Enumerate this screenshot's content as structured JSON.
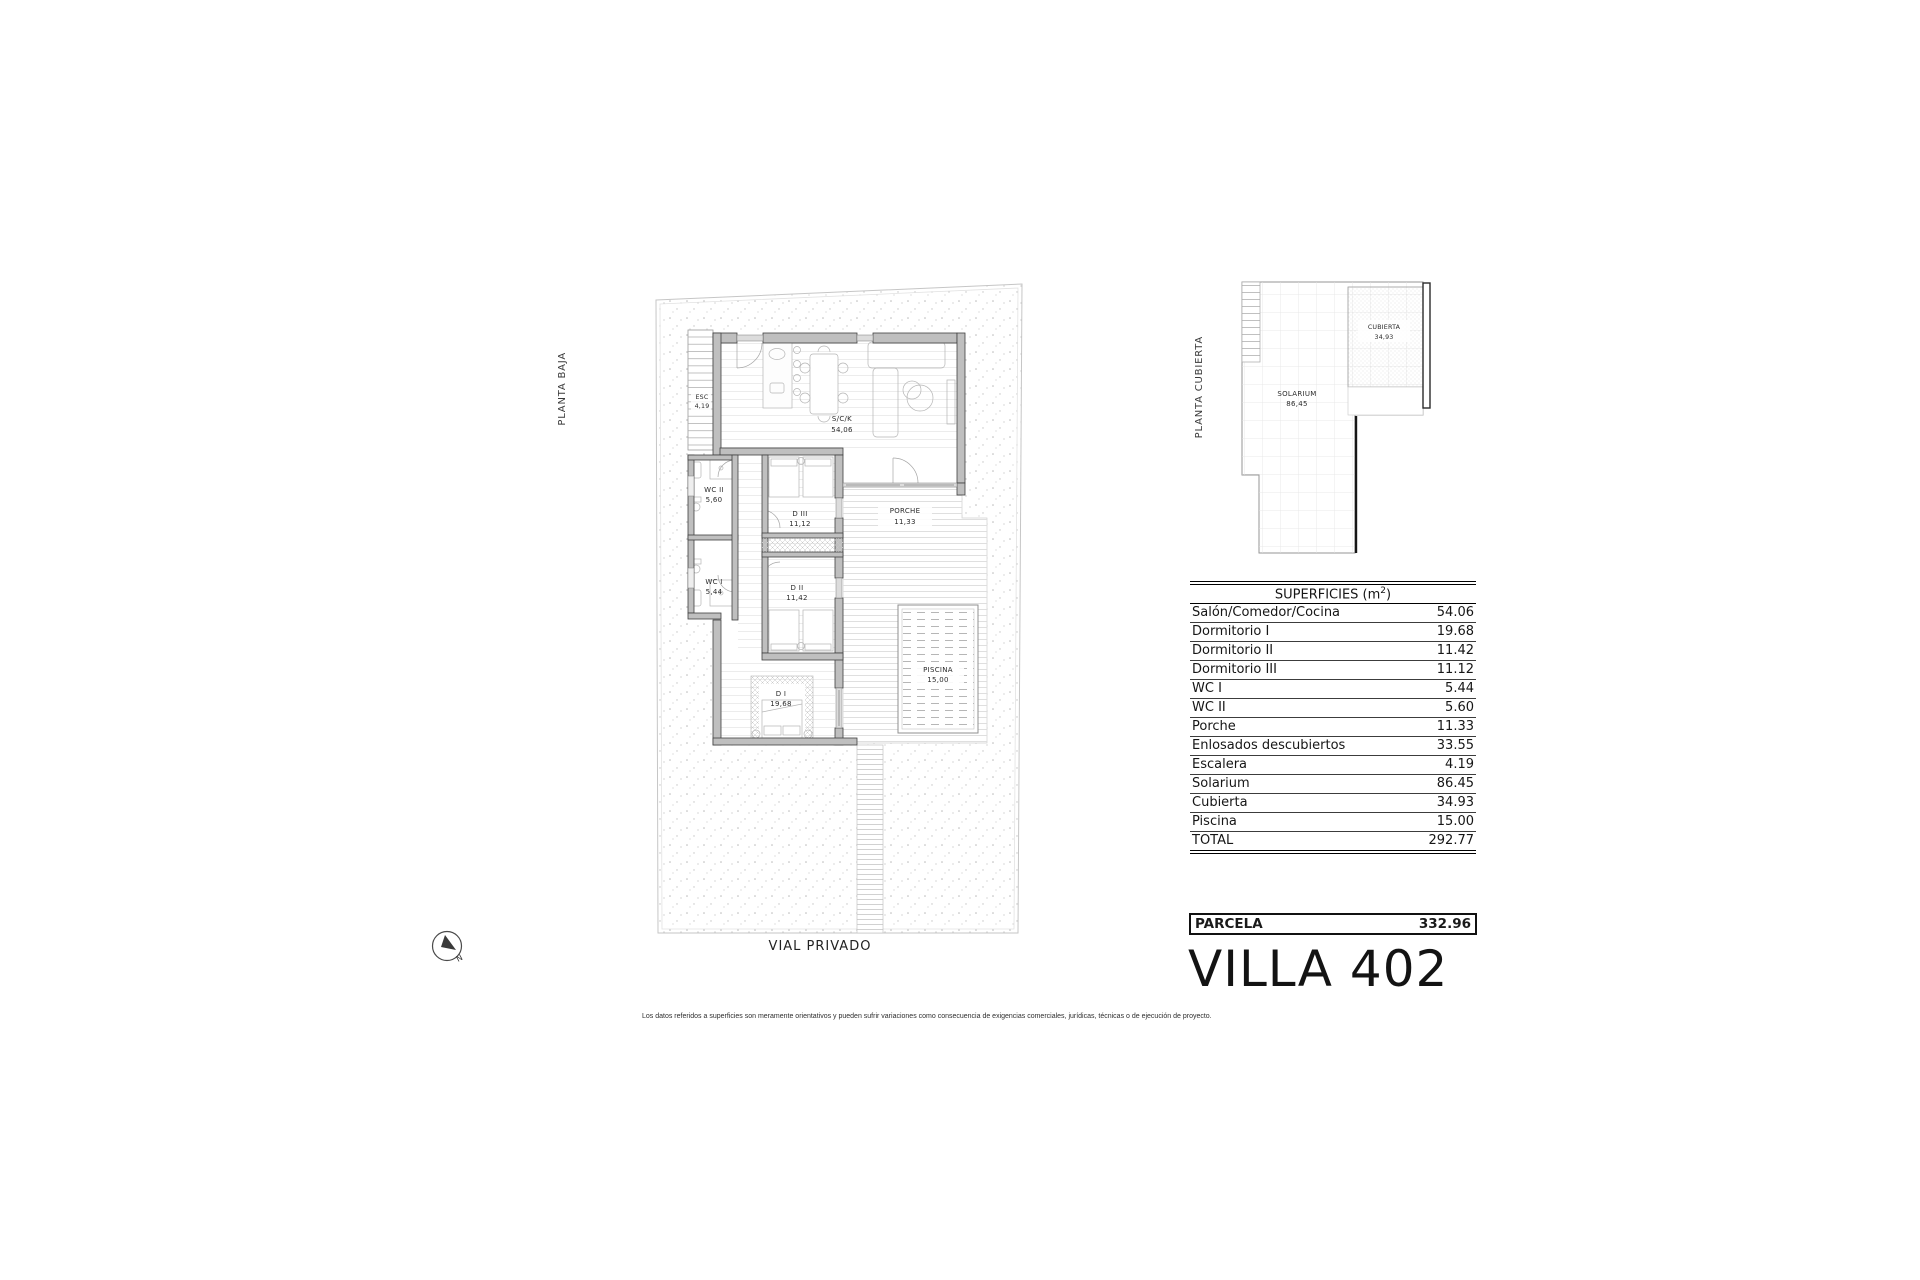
{
  "plans": {
    "floor": {
      "label": "PLANTA BAJA",
      "street_label": "VIAL PRIVADO",
      "rooms": [
        {
          "id": "esc",
          "name": "ESC",
          "area": "4,19"
        },
        {
          "id": "sck",
          "name": "S/C/K",
          "area": "54,06"
        },
        {
          "id": "wc2",
          "name": "WC II",
          "area": "5,60"
        },
        {
          "id": "d3",
          "name": "D III",
          "area": "11,12"
        },
        {
          "id": "porche",
          "name": "PORCHE",
          "area": "11,33"
        },
        {
          "id": "wc1",
          "name": "WC I",
          "area": "5,44"
        },
        {
          "id": "d2",
          "name": "D II",
          "area": "11,42"
        },
        {
          "id": "d1",
          "name": "D I",
          "area": "19,68"
        },
        {
          "id": "piscina",
          "name": "PISCINA",
          "area": "15,00"
        }
      ]
    },
    "roof": {
      "label": "PLANTA CUBIERTA",
      "rooms": [
        {
          "id": "cubierta",
          "name": "CUBIERTA",
          "area": "34,93"
        },
        {
          "id": "solarium",
          "name": "SOLARIUM",
          "area": "86,45"
        }
      ]
    }
  },
  "north_arrow": {
    "letter": "N"
  },
  "surfaces_table": {
    "title_prefix": "SUPERFICIES (m",
    "title_sup": "2",
    "title_suffix": ")",
    "rows": [
      {
        "label": "Salón/Comedor/Cocina",
        "value": "54.06"
      },
      {
        "label": "Dormitorio I",
        "value": "19.68"
      },
      {
        "label": "Dormitorio II",
        "value": "11.42"
      },
      {
        "label": "Dormitorio III",
        "value": "11.12"
      },
      {
        "label": "WC I",
        "value": "5.44"
      },
      {
        "label": "WC II",
        "value": "5.60"
      },
      {
        "label": "Porche",
        "value": "11.33"
      },
      {
        "label": "Enlosados descubiertos",
        "value": "33.55"
      },
      {
        "label": "Escalera",
        "value": "4.19"
      },
      {
        "label": "Solarium",
        "value": "86.45"
      },
      {
        "label": "Cubierta",
        "value": "34.93"
      },
      {
        "label": "Piscina",
        "value": "15.00"
      },
      {
        "label": "TOTAL",
        "value": "292.77"
      }
    ]
  },
  "parcela": {
    "label": "PARCELA",
    "value": "332.96"
  },
  "villa_title": "VILLA 402",
  "disclaimer": "Los datos referidos a superficies son meramente orientativos y pueden sufrir variaciones como consecuencia de exigencias comerciales, jurídicas, técnicas o de ejecución de proyecto.",
  "colors": {
    "wall": "#bfbfbf",
    "wall_edge": "#404040",
    "gravel_dot": "#bdbdbd",
    "accent_dark": "#111111"
  }
}
